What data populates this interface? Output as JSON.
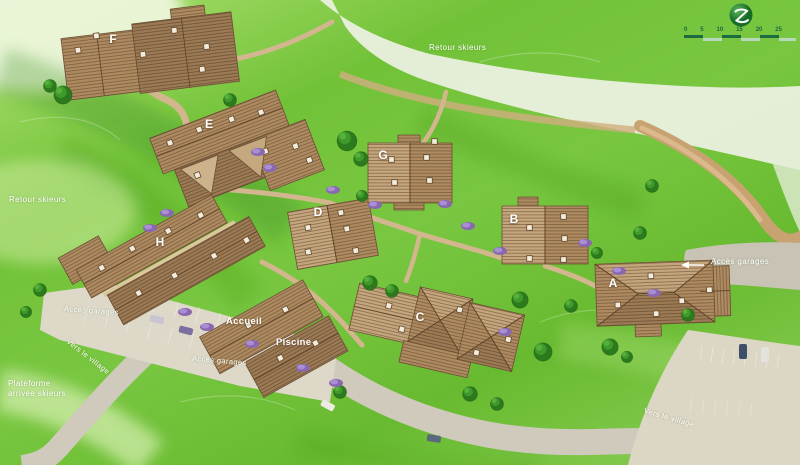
{
  "title": "Illustrated resort site plan",
  "logo": {
    "icon": "z-swoosh-leaf-icon"
  },
  "scale_bar": {
    "ticks": [
      "0",
      "5",
      "10",
      "15",
      "20",
      "25"
    ]
  },
  "labels": {
    "retour_skieurs_top": "Retour skieurs",
    "retour_skieurs_left": "Retour skieurs",
    "plateforme_line1": "Plateforme",
    "plateforme_line2": "arrivée skieurs",
    "acces_garages_west": "Accès garages",
    "acces_garages_center": "Accès garages",
    "acces_garages_east": "Accès garages",
    "vers_le_village_southwest": "Vers le village",
    "vers_le_village_southeast": "Vers le village",
    "accueil": "Accueil",
    "piscine": "Piscine"
  },
  "building_letters": {
    "a": "A",
    "b": "B",
    "c": "C",
    "d": "D",
    "e": "E",
    "f": "F",
    "g": "G",
    "h": "H"
  },
  "colors": {
    "grass": "#72c238",
    "grass_light": "#cde9a0",
    "grass_dark": "#2f8414",
    "slope": "#e9efdd",
    "road": "#cfcabb",
    "parking": "#ddd8c8",
    "dirt_path": "#d2b68d",
    "roof_light": "#c4a67e",
    "roof_mid": "#ad8a60",
    "roof_dark": "#9b7a54",
    "roof_line": "#6b4f33",
    "tree": "#2c7a1e",
    "bush": "#8a68b0",
    "label_text": "#ffffff",
    "logo_green": "#1c7a2c",
    "scale_dark": "#1b6a40",
    "scale_light": "#b7d8bd"
  }
}
